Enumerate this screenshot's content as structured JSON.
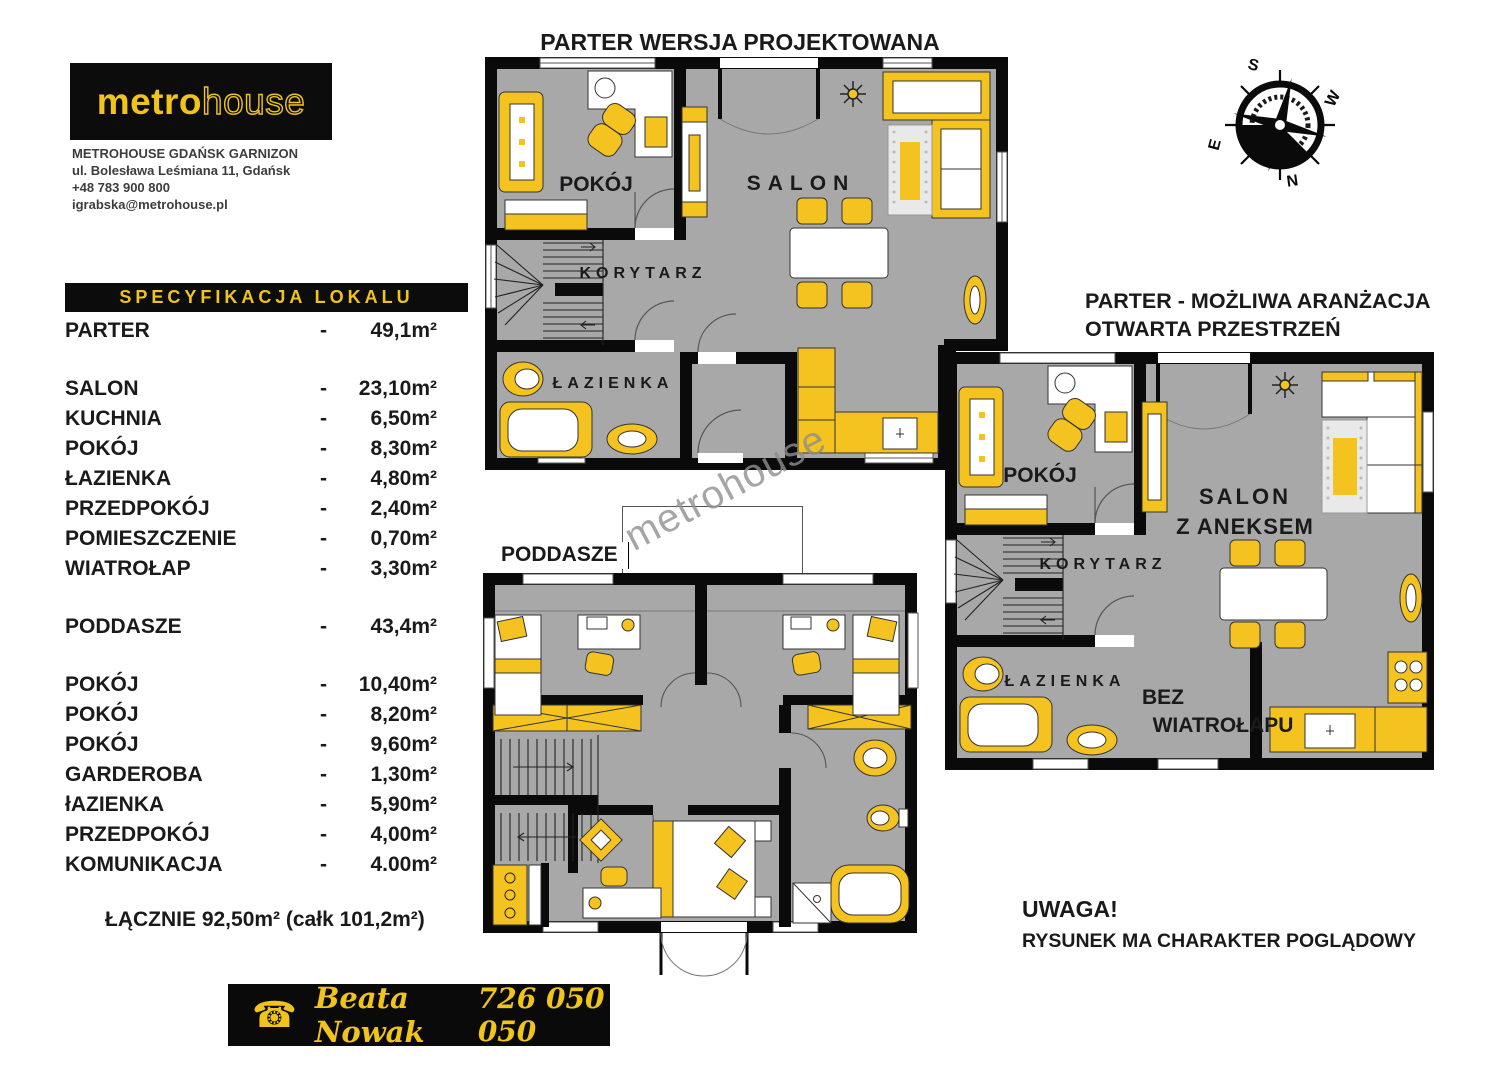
{
  "agency": {
    "logo_part1": "metro",
    "logo_part2": "house",
    "office": "METROHOUSE GDAŃSK GARNIZON",
    "address": "ul. Bolesława Leśmiana 11, Gdańsk",
    "phone": "+48 783 900 800",
    "email": "igrabska@metrohouse.pl"
  },
  "spec": {
    "header": "SPECYFIKACJA LOKALU",
    "dash": "-",
    "groups": [
      [
        {
          "label": "PARTER",
          "area": "49,1m²"
        }
      ],
      [
        {
          "label": "SALON",
          "area": "23,10m²"
        },
        {
          "label": "KUCHNIA",
          "area": "6,50m²"
        },
        {
          "label": "POKÓJ",
          "area": "8,30m²"
        },
        {
          "label": "ŁAZIENKA",
          "area": "4,80m²"
        },
        {
          "label": "PRZEDPOKÓJ",
          "area": "2,40m²"
        },
        {
          "label": "POMIESZCZENIE",
          "area": "0,70m²"
        },
        {
          "label": "WIATROŁAP",
          "area": "3,30m²"
        }
      ],
      [
        {
          "label": "PODDASZE",
          "area": "43,4m²"
        }
      ],
      [
        {
          "label": "POKÓJ",
          "area": "10,40m²"
        },
        {
          "label": "POKÓJ",
          "area": "8,20m²"
        },
        {
          "label": "POKÓJ",
          "area": "9,60m²"
        },
        {
          "label": "GARDEROBA",
          "area": "1,30m²"
        },
        {
          "label": "łAZIENKA",
          "area": "5,90m²"
        },
        {
          "label": "PRZEDPOKÓJ",
          "area": "4,00m²"
        },
        {
          "label": "KOMUNIKACJA",
          "area": "4.00m²"
        }
      ]
    ],
    "total": "ŁĄCZNIE  92,50m² (całk 101,2m²)"
  },
  "plans": {
    "parter": {
      "title": "PARTER WERSJA PROJEKTOWANA",
      "rooms": {
        "pokoj": "POKÓJ",
        "salon": "SALON",
        "korytarz": "KORYTARZ",
        "lazienka": "ŁAZIENKA"
      }
    },
    "poddasze": {
      "title": "PODDASZE"
    },
    "otwarta": {
      "title_line1": "PARTER - MOŻLIWA ARANŻACJA",
      "title_line2": "OTWARTA PRZESTRZEŃ",
      "rooms": {
        "pokoj": "POKÓJ",
        "salon_line1": "SALON",
        "salon_line2": "Z ANEKSEM",
        "korytarz": "KORYTARZ",
        "lazienka": "ŁAZIENKA",
        "bez_line1": "BEZ",
        "bez_line2": "WIATROŁAPU"
      }
    }
  },
  "compass": {
    "n": "N",
    "s": "S",
    "e": "E",
    "w": "W"
  },
  "note": {
    "line1": "UWAGA!",
    "line2": "RYSUNEK MA CHARAKTER  POGLĄDOWY"
  },
  "contact": {
    "name": "Beata Nowak",
    "phone": "726 050 050"
  },
  "watermark": "metrohouse",
  "colors": {
    "accent_yellow": "#f5c320",
    "logo_yellow": "#f0c41a",
    "floor_gray": "#a8a8a8",
    "wall_black": "#0a0a0a"
  }
}
